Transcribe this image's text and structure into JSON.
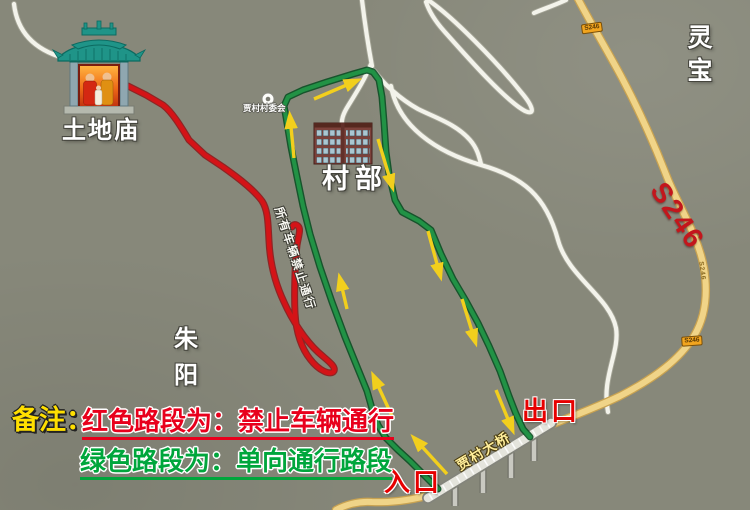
{
  "labels": {
    "temple": "土地庙",
    "village_office": "村部",
    "poi": "贾村村委会",
    "region_right": "灵宝",
    "region_left": "朱阳",
    "bridge": "贾村大桥",
    "entrance": "入口",
    "exit": "出口",
    "route_note": "所有车辆禁止通行",
    "road_name_big": "S246",
    "road_badge_top": "S246",
    "road_badge_bottom": "S246",
    "road_small": "S246"
  },
  "legend": {
    "prefix": "备注：",
    "red_rule": "红色路段为：禁止车辆通行",
    "green_rule": "绿色路段为：单向通行路段"
  },
  "colors": {
    "background": "#87887a",
    "red_route": "#d41317",
    "green_route": "#219245",
    "arrow_yellow": "#f2cf1d",
    "highway_yellow": "#f0d488",
    "minor_road_white": "#f3f3eb",
    "badge_orange": "#f2a51f",
    "marker_red": "#e60000",
    "legend_red": "#e8001c",
    "legend_green": "#00a63c",
    "legend_yellow": "#ffdf00"
  }
}
